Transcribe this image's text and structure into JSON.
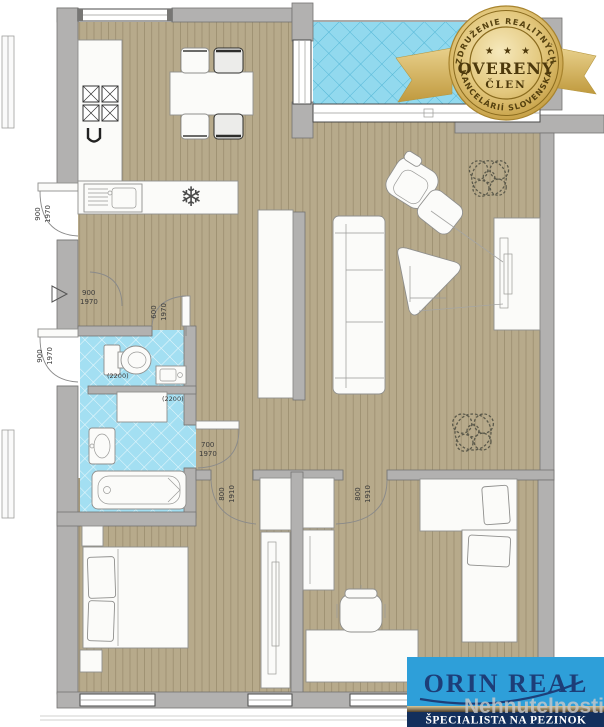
{
  "badge": {
    "arc_top": "ZDRUŽENIE REALITNÝCH",
    "arc_bottom": "KANCELÁRIÍ SLOVENSKA",
    "stars": "★ ★ ★",
    "title": "OVERENÝ",
    "subtitle": "ČLEN",
    "colors": {
      "gold": "#d9b55f",
      "gold_light": "#f6e9bc",
      "text": "#55410f"
    }
  },
  "logo": {
    "brand": "ORIN REAL",
    "tagline": "ŠPECIALISTA NA PEZINOK",
    "watermark": "Nehnutelnosti",
    "colors": {
      "sky": "#2e9fd9",
      "navy": "#132f5c",
      "brand_text": "#1d3e78"
    }
  },
  "plan": {
    "ceiling_heights": {
      "wc": "(2200)",
      "bathroom": "(2200)"
    },
    "door_labels": {
      "exterior_upper": {
        "w": "900",
        "h": "1970"
      },
      "entry": {
        "w": "900",
        "h": "1970"
      },
      "exterior_lower": {
        "w": "900",
        "h": "1970"
      },
      "wc": {
        "w": "600",
        "h": "1970"
      },
      "bathroom": {
        "w": "700",
        "h": "1970"
      },
      "bedroom_left": {
        "w": "800",
        "h": "1910"
      },
      "bedroom_right": {
        "w": "800",
        "h": "1910"
      }
    },
    "symbols": {
      "snowflake": "❄"
    },
    "colors": {
      "wood": "#b7aa8b",
      "wood_line": "#9b8e6f",
      "tile": "#a3dff2",
      "tile_grid": "#e8f8fc",
      "balcony_tile": "#92d9ee",
      "balcony_grid": "#54b7d6",
      "wall": "#b2b1b0"
    }
  }
}
